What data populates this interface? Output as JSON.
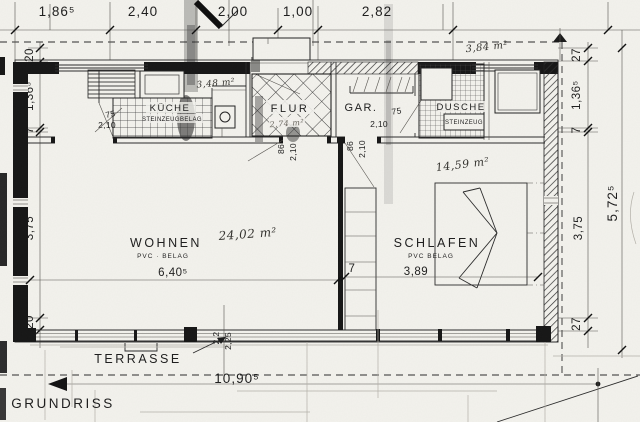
{
  "title": "GRUNDRISS",
  "labels": {
    "terrasse": "TERRASSE"
  },
  "dims": {
    "top": [
      "1,86⁵",
      "2,40",
      "2,00",
      "1,00",
      "2,82"
    ],
    "left": [
      "20",
      "1,36⁵",
      "7",
      "3,75",
      "20"
    ],
    "right": [
      "27",
      "1,36⁵",
      "7",
      "3,75",
      "27"
    ],
    "right_total": "5,72⁵",
    "bottom_total": "10,90⁵",
    "terrace": [
      "2,2",
      "2,25"
    ]
  },
  "rooms": {
    "wohnen": {
      "name": "WOHNEN",
      "floor": "PVC · BELAG",
      "area": "24,02 m²",
      "width": "6,40⁵"
    },
    "schlafen": {
      "name": "SCHLAFEN",
      "floor": "PVC BELAG",
      "area": "14,59 m²",
      "width": "3,89",
      "wall": "7"
    },
    "kueche": {
      "name": "KÜCHE",
      "floor": "STEINZEUGBELAG",
      "area": "3,48 m²",
      "door_w": "75",
      "door_h": "2,10"
    },
    "flur": {
      "name": "FLUR",
      "area": "2,74 m²",
      "door_w": "86",
      "door_h": "2,10"
    },
    "gar": {
      "name": "GAR.",
      "door_w": "75",
      "door_h": "2,10",
      "door2_w": "86",
      "door2_h": "2,10"
    },
    "dusche": {
      "name": "DUSCHE",
      "floor": "STEINZEUG",
      "area": "3,84 m²"
    }
  }
}
